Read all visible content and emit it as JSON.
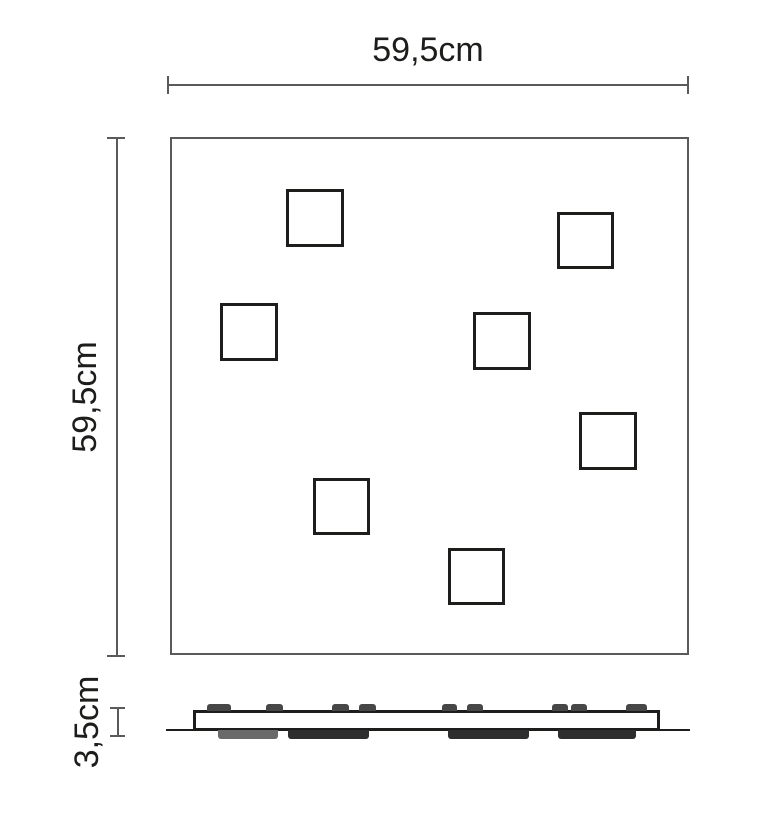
{
  "drawing": {
    "type": "technical-dimension-drawing",
    "views": [
      "top view",
      "side profile"
    ]
  },
  "theme": {
    "bg": "#ffffff",
    "dim": "#595a5c",
    "outline": "#595a5c",
    "detail": "#1d1d1b",
    "clip": "#474747",
    "text": "#1d1d1b"
  },
  "labels": {
    "width": "59,5cm",
    "height": "59,5cm",
    "depth": "3,5cm"
  },
  "geometry": {
    "width_dim": {
      "line": {
        "x": 168,
        "y": 84,
        "w": 521,
        "h": 2
      },
      "tick_a": {
        "x": 167,
        "y": 76,
        "w": 2,
        "h": 18
      },
      "tick_b": {
        "x": 687,
        "y": 76,
        "w": 2,
        "h": 18
      },
      "label_center": {
        "x": 428,
        "y": 50
      }
    },
    "height_dim": {
      "line": {
        "x": 116,
        "y": 138,
        "w": 2,
        "h": 519
      },
      "tick_a": {
        "x": 107,
        "y": 137,
        "w": 18,
        "h": 2
      },
      "tick_b": {
        "x": 107,
        "y": 655,
        "w": 18,
        "h": 2
      },
      "label_center": {
        "x": 85,
        "y": 397
      }
    },
    "depth_dim": {
      "line": {
        "x": 117,
        "y": 708,
        "w": 2,
        "h": 29
      },
      "tick_a": {
        "x": 110,
        "y": 707,
        "w": 15,
        "h": 2
      },
      "tick_b": {
        "x": 110,
        "y": 735,
        "w": 15,
        "h": 2
      },
      "label_center": {
        "x": 87,
        "y": 722
      }
    },
    "panel": {
      "x": 170,
      "y": 137,
      "w": 519,
      "h": 518
    },
    "cutouts": [
      {
        "x": 286,
        "y": 189,
        "s": 58
      },
      {
        "x": 557,
        "y": 212,
        "s": 57
      },
      {
        "x": 220,
        "y": 303,
        "s": 58
      },
      {
        "x": 473,
        "y": 312,
        "s": 58
      },
      {
        "x": 579,
        "y": 412,
        "s": 58
      },
      {
        "x": 313,
        "y": 478,
        "s": 57
      },
      {
        "x": 448,
        "y": 548,
        "s": 57
      }
    ],
    "side": {
      "baseline": {
        "x": 166,
        "y": 729,
        "w": 524,
        "h": 2
      },
      "bar": {
        "x": 193,
        "y": 710,
        "w": 467,
        "h": 21
      },
      "clips": [
        {
          "x": 207,
          "y": 704,
          "w": 24,
          "h": 7
        },
        {
          "x": 266,
          "y": 704,
          "w": 17,
          "h": 7
        },
        {
          "x": 332,
          "y": 704,
          "w": 17,
          "h": 7
        },
        {
          "x": 359,
          "y": 704,
          "w": 17,
          "h": 7
        },
        {
          "x": 442,
          "y": 704,
          "w": 15,
          "h": 7
        },
        {
          "x": 467,
          "y": 704,
          "w": 16,
          "h": 7
        },
        {
          "x": 552,
          "y": 704,
          "w": 16,
          "h": 7
        },
        {
          "x": 571,
          "y": 704,
          "w": 16,
          "h": 7
        },
        {
          "x": 626,
          "y": 704,
          "w": 21,
          "h": 7
        }
      ],
      "strips": [
        {
          "x": 218,
          "y": 730,
          "w": 60,
          "h": 9,
          "color": "#6a6a6a"
        },
        {
          "x": 288,
          "y": 730,
          "w": 81,
          "h": 9,
          "color": "#2e2e2e"
        },
        {
          "x": 448,
          "y": 730,
          "w": 81,
          "h": 9,
          "color": "#2e2e2e"
        },
        {
          "x": 558,
          "y": 730,
          "w": 78,
          "h": 9,
          "color": "#2e2e2e"
        }
      ]
    }
  }
}
